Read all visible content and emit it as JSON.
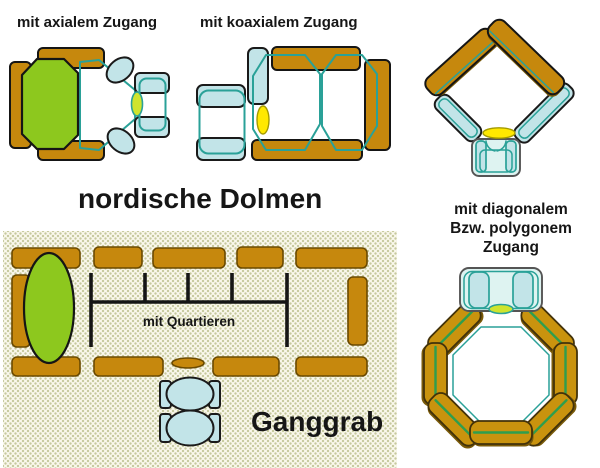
{
  "figure_title": "Megalithic tomb ground-plan types",
  "labels": {
    "axial_caption": "mit axialem Zugang",
    "koaxial_caption": "mit koaxialem Zugang",
    "group_title": "nordische Dolmen",
    "diagonal_caption_lines": [
      "mit diagonalem",
      "Bzw. polygonem",
      "Zugang"
    ],
    "quartieren_annotation": "mit Quartieren",
    "ganggrab_title": "Ganggrab"
  },
  "colors": {
    "stone_orange": "#C6880D",
    "stone_orange_oct": "#C9930E",
    "stone_orange_dark": "#7A5A08",
    "chamber_green": "#8DC81E",
    "stone_blue": "#C2E4E8",
    "stone_blue_pale": "#DEF3F1",
    "outline_teal": "#2AA198",
    "line_green": "#2E9E4E",
    "marker_yellow": "#FFE800",
    "marker_yellowgreen": "#CFE42E",
    "panel_bg": "#FAF8EC",
    "panel_dot": "#C6C99E"
  }
}
